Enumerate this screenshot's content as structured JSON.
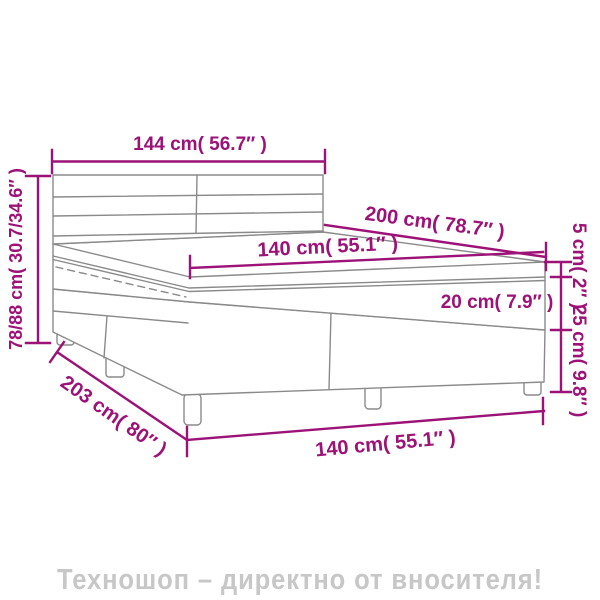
{
  "colors": {
    "dimension_accent": "#9c1277",
    "bed_outline": "#8a8a8a",
    "watermark": "#c7c7c7",
    "background": "#ffffff"
  },
  "labels": {
    "headboard_width": "144 cm( 56.7″ )",
    "headboard_height": "78/88 cm( 30.7/34.6″ )",
    "bed_length": "200 cm( 78.7″ )",
    "mattress_top_width": "140 cm( 55.1″ )",
    "topper_thickness": "5 cm( 2″ )",
    "mattress_thickness": "20 cm( 7.9″ )",
    "base_height": "25 cm( 9.8″ )",
    "base_length": "203 cm( 80″ )",
    "base_width": "140 cm( 55.1″ )"
  },
  "watermark": {
    "text": "Техношоп – директно от вносителя!"
  }
}
